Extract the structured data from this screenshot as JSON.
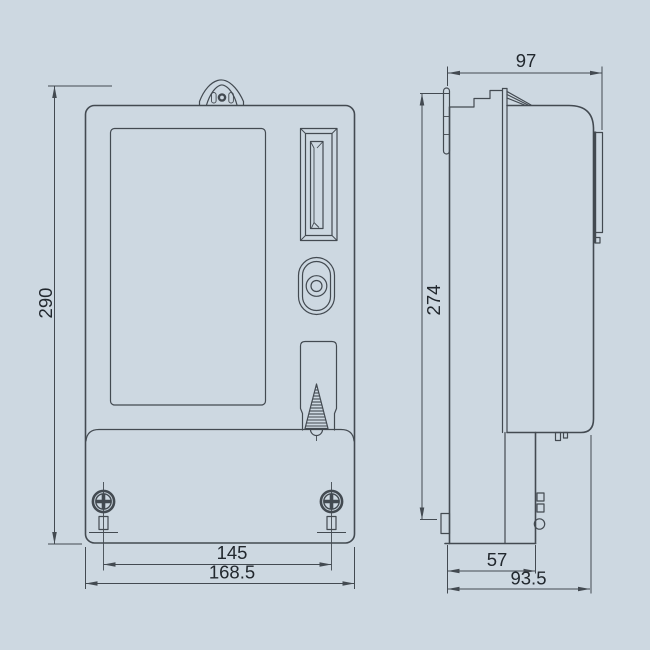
{
  "colors": {
    "background": "#cdd8e1",
    "line": "#434a51",
    "text": "#22282e"
  },
  "front_view": {
    "dim_height": "290",
    "dim_hole_spacing": "145",
    "dim_width": "168.5"
  },
  "side_view": {
    "dim_depth_upper": "97",
    "dim_height": "274",
    "dim_depth_terminal": "57",
    "dim_depth_overall": "93.5"
  }
}
